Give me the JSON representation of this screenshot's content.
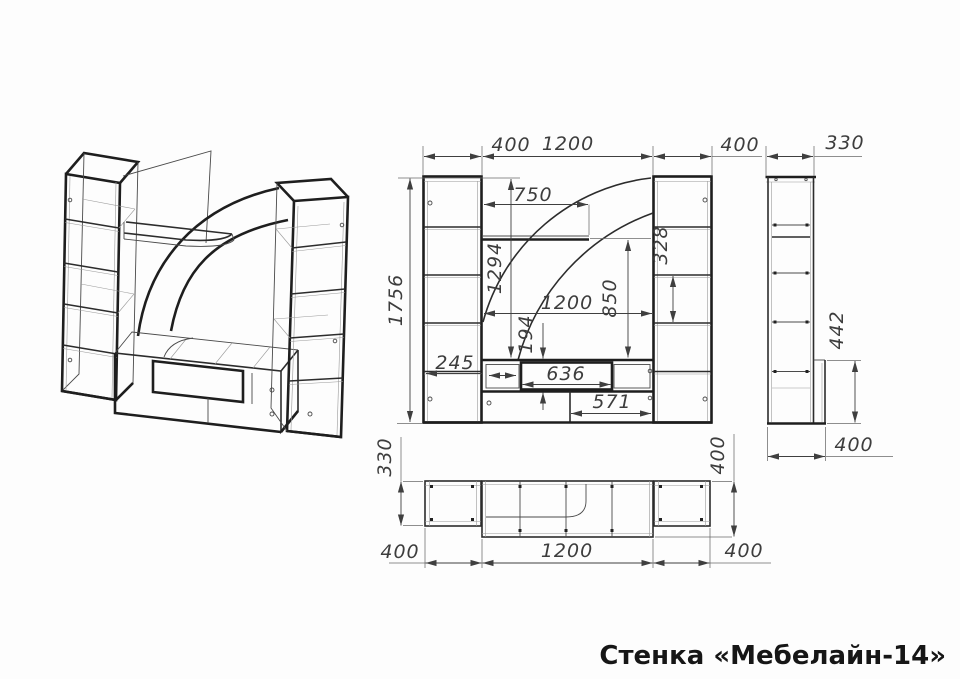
{
  "drawing": {
    "title": "Стенка «Мебелайн-14»"
  },
  "dimensions": {
    "front": {
      "left_width": "400",
      "center_width": "1200",
      "right_width": "400",
      "total_height": "1756",
      "shelf_width": "750",
      "open_height": "1294",
      "right_gap": "328",
      "panel_height": "850",
      "inner_width": "1200",
      "niche_height": "194",
      "door_width": "245",
      "niche_width": "636",
      "compartment_width": "571"
    },
    "side": {
      "depth_top": "330",
      "stand_height": "442",
      "depth_bottom": "400"
    },
    "plan": {
      "left_depth": "330",
      "right_depth": "400",
      "left_width": "400",
      "center_width": "1200",
      "right_width": "400"
    }
  }
}
